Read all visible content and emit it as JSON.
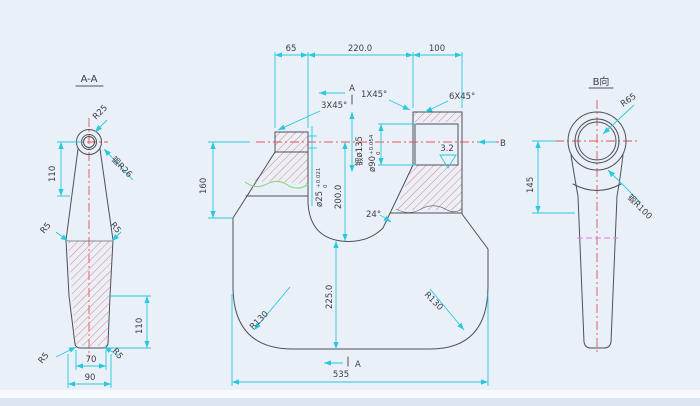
{
  "colors": {
    "background": "#eaf0f8",
    "line": "#4f4f58",
    "dimension": "#2ac8dc",
    "centerline": "#e25555",
    "hatch": "#ee7070",
    "break_line": "#8fd98f",
    "phantom": "#e77ae0"
  },
  "section_aa": {
    "title": "A-A",
    "r25": "R25",
    "forge_r26": "锻R26",
    "dim110_upper": "110",
    "dim110_lower": "110",
    "r5_upper_left": "R5",
    "r5_upper_right": "R5",
    "r5_lower_left": "R5",
    "r5_lower_right": "R5",
    "dim70": "70",
    "dim90": "90"
  },
  "front": {
    "dim65": "65",
    "dim220": "220.0",
    "dim100": "100",
    "section_mark_top": "A",
    "section_mark_bottom": "A",
    "chamfer_1x45": "1X45°",
    "chamfer_3x45": "3X45°",
    "chamfer_6x45": "6X45°",
    "bore25": "ø25",
    "bore25_tol_upper": "+0.021",
    "bore25_tol_lower": "0",
    "dim200": "200.0",
    "forge_dia135": "锻ø135",
    "bore90": "ø90",
    "bore90_tol_upper": "+0.054",
    "bore90_tol_lower": "0",
    "roughness": "3.2",
    "angle24": "24°",
    "dim225": "225.0",
    "r130_left": "R130",
    "r130_right": "R130",
    "dim535": "535",
    "view_b_mark": "B"
  },
  "view_b": {
    "title": "B向",
    "r65": "R65",
    "forge_r100": "锻R100",
    "dim145": "145"
  }
}
